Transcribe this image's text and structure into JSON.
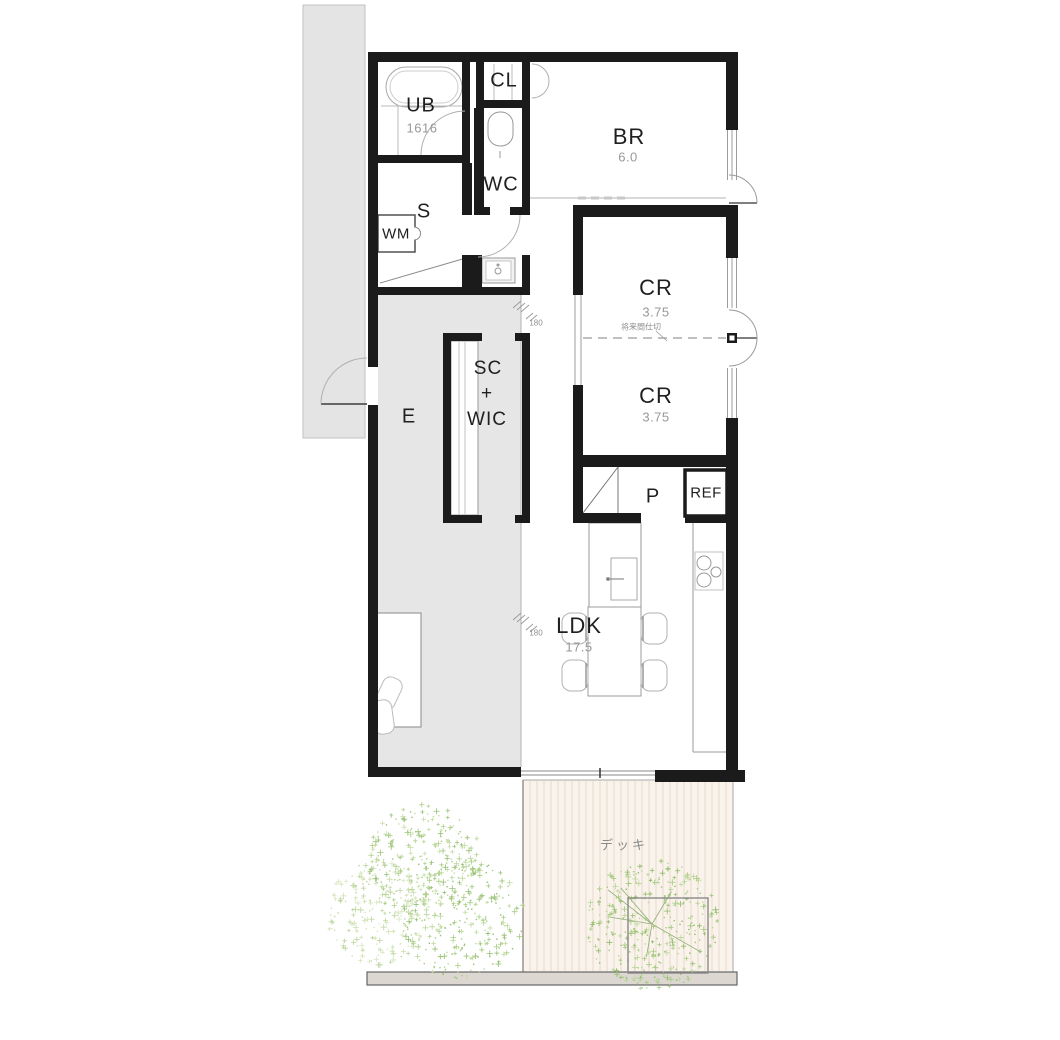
{
  "rooms": {
    "ub": {
      "label": "UB",
      "size": "1616"
    },
    "cl": {
      "label": "CL"
    },
    "wc": {
      "label": "WC"
    },
    "s": {
      "label": "S"
    },
    "wm": {
      "label": "WM"
    },
    "br": {
      "label": "BR",
      "area": "6.0"
    },
    "cr1": {
      "label": "CR",
      "area": "3.75"
    },
    "cr2": {
      "label": "CR",
      "area": "3.75"
    },
    "p": {
      "label": "P"
    },
    "ref": {
      "label": "REF"
    },
    "scwic": {
      "line1": "SC",
      "line2": "+",
      "line3": "WIC"
    },
    "e": {
      "label": "E"
    },
    "ldk": {
      "label": "LDK",
      "area": "17.5"
    }
  },
  "annotations": {
    "future_partition": "将来間仕切",
    "deck": "デッキ",
    "step_height": "180"
  },
  "colors": {
    "wall": "#1b1b1b",
    "entry_floor": "#e6e6e6",
    "porch": "#e4e4e4",
    "deck": "#faf3ec",
    "deck_stripe": "#e9ddd1",
    "ground_bar": "#dcd7d0",
    "tree_green": "#a9cd83",
    "sub_text": "#989898"
  }
}
